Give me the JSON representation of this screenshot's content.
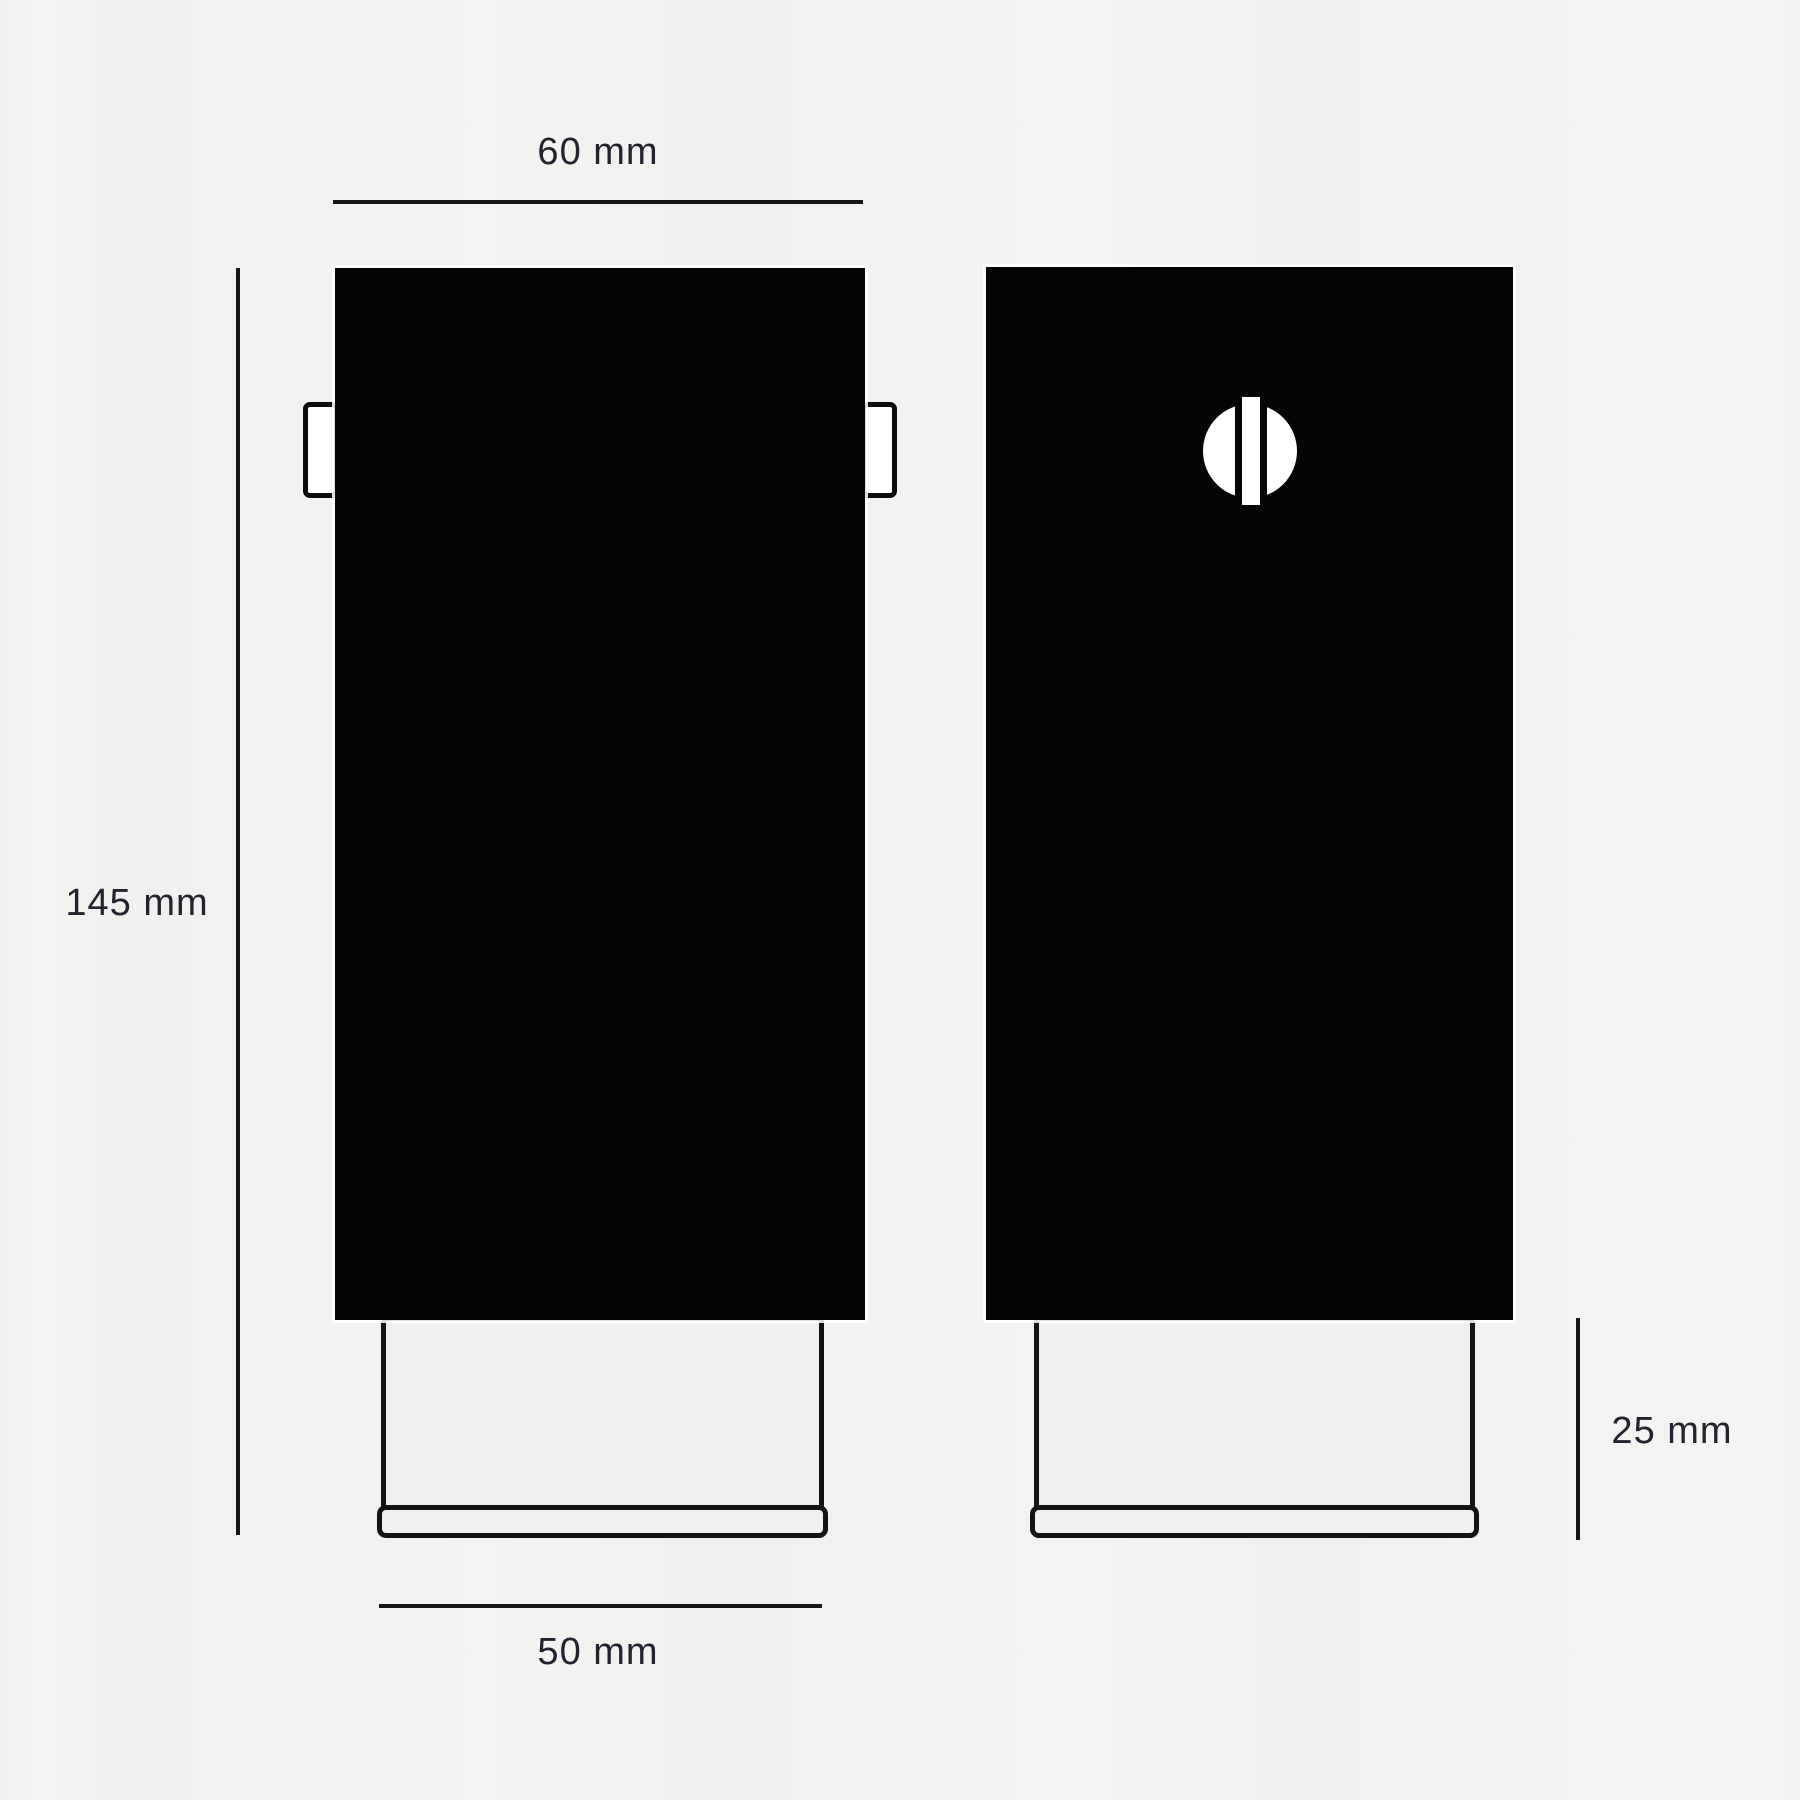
{
  "drawing": {
    "type": "technical-dimension-drawing",
    "views": {
      "front": {
        "name": "front view",
        "features": [
          "body",
          "side-tab-left",
          "side-tab-right",
          "base",
          "base-plate"
        ]
      },
      "side": {
        "name": "side view",
        "features": [
          "body",
          "screw-head-detail",
          "base",
          "base-plate"
        ]
      }
    },
    "dimensions": {
      "body_width": "60 mm",
      "total_height": "145 mm",
      "base_width": "50 mm",
      "base_height": "25 mm"
    }
  },
  "colors": {
    "background": "#f0f0ef",
    "ink": "#161616",
    "body_fill": "#050505",
    "label_text": "#23232f",
    "detail_white": "#ffffff"
  }
}
